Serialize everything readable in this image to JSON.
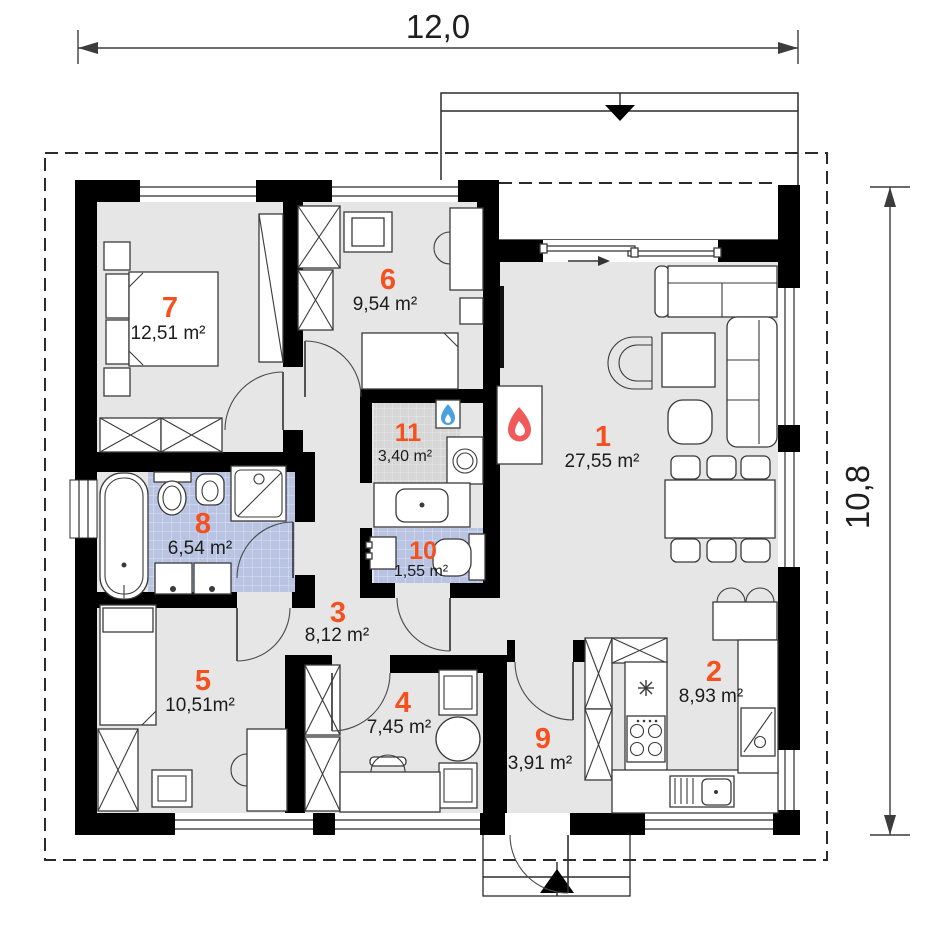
{
  "dimensions": {
    "width": "12,0",
    "height": "10,8"
  },
  "rooms": [
    {
      "number": "1",
      "area": "27,55 m²"
    },
    {
      "number": "2",
      "area": "8,93 m²"
    },
    {
      "number": "3",
      "area": "8,12 m²"
    },
    {
      "number": "4",
      "area": "7,45 m²"
    },
    {
      "number": "5",
      "area": "10,51m²"
    },
    {
      "number": "6",
      "area": "9,54 m²"
    },
    {
      "number": "7",
      "area": "12,51 m²"
    },
    {
      "number": "8",
      "area": "6,54 m²"
    },
    {
      "number": "9",
      "area": "3,91 m²"
    },
    {
      "number": "10",
      "area": "1,55 m²"
    },
    {
      "number": "11",
      "area": "3,40 m²"
    }
  ],
  "colors": {
    "room_number": "#f4511e",
    "area_text": "#1c1c1c",
    "wall": "#000000",
    "floor": "#e6e6e6",
    "tile_blue": "#b9c4e2",
    "tile_gray": "#d6d6d6",
    "fireplace_flame": "#f05a5a",
    "boiler_flame": "#4aa0e0"
  },
  "icons": {
    "fireplace_flame": "flame",
    "boiler_flame": "flame",
    "fridge_star": "asterisk",
    "roof_slope_arrow": "triangle-down",
    "entrance_arrow": "triangle-up",
    "slide_direction_arrow": "arrow-right"
  }
}
